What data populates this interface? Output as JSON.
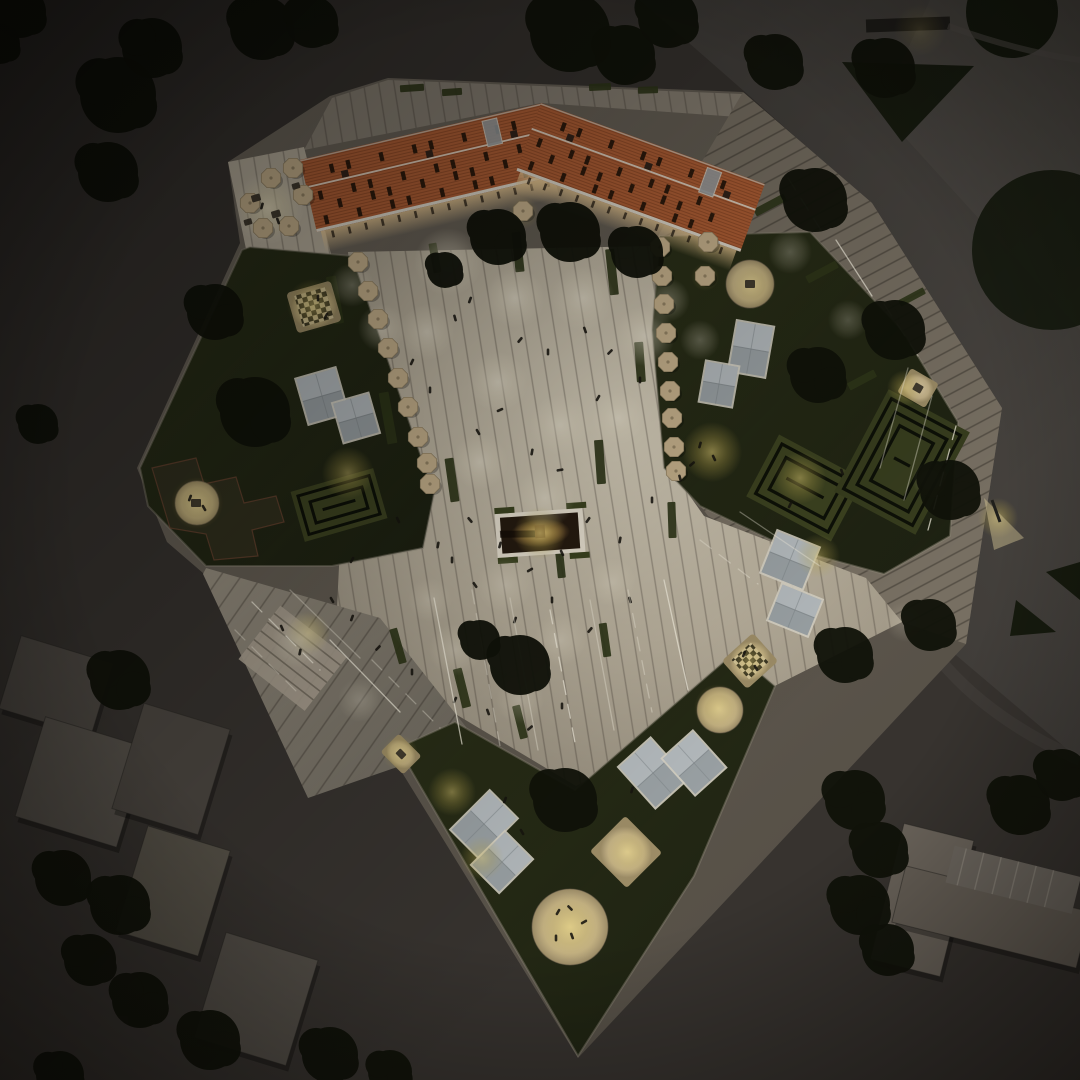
{
  "meta": {
    "description": "Aerial night rendering of an urban plaza with orange-roofed building, illuminated paving, gardens, mazes and surrounding blocks"
  },
  "colors": {
    "bg": "#37332f",
    "roof": "#b05f35",
    "eaves": "#ded8ca",
    "siteBase": "#6b6459",
    "umbrella": "#c6b18c",
    "umbrellaDark": "#8f7f60",
    "tree": "#101209",
    "person": "#17140f",
    "led": "#f7f2e2",
    "greenStrip": "#2f3619",
    "glassFrame": "#d5d0c3",
    "glassPane": "#99a0a3",
    "glassPaneLight": "#bcc2c4",
    "sandRim": "#6f6350",
    "hedge": "#0d1007",
    "mazeLawn": "#3c4220"
  },
  "building": {
    "wings": [
      {
        "x": 300,
        "y": 160,
        "w": 248,
        "h": 74,
        "rot": -13.2,
        "cx": 300,
        "cy": 160
      },
      {
        "x": 541,
        "y": 103,
        "w": 238,
        "h": 72,
        "rot": 19.9,
        "cx": 541,
        "cy": 103
      }
    ]
  },
  "scene": {
    "pools": [
      [
        448,
        262,
        34,
        0.5
      ],
      [
        515,
        298,
        30,
        0.55
      ],
      [
        583,
        298,
        32,
        0.5
      ],
      [
        645,
        336,
        30,
        0.5
      ],
      [
        427,
        332,
        28,
        0.45
      ],
      [
        498,
        382,
        30,
        0.5
      ],
      [
        560,
        425,
        30,
        0.45
      ],
      [
        480,
        462,
        28,
        0.45
      ],
      [
        618,
        418,
        26,
        0.4
      ],
      [
        545,
        498,
        30,
        0.4
      ],
      [
        382,
        328,
        24,
        0.4
      ],
      [
        352,
        285,
        22,
        0.35
      ],
      [
        668,
        300,
        22,
        0.35
      ],
      [
        700,
        340,
        20,
        0.3
      ],
      [
        505,
        585,
        28,
        0.3
      ],
      [
        455,
        650,
        26,
        0.3
      ],
      [
        560,
        640,
        26,
        0.28
      ],
      [
        612,
        582,
        24,
        0.28
      ],
      [
        520,
        700,
        24,
        0.25
      ],
      [
        430,
        600,
        22,
        0.25
      ],
      [
        790,
        252,
        22,
        0.3
      ],
      [
        848,
        320,
        20,
        0.25
      ],
      [
        300,
        640,
        28,
        0.4
      ],
      [
        360,
        700,
        22,
        0.25
      ],
      [
        930,
        480,
        18,
        0.2
      ],
      [
        268,
        208,
        36,
        0.5
      ],
      [
        905,
        622,
        20,
        0.18
      ]
    ],
    "glows": [
      [
        313,
        305,
        26,
        0.55
      ],
      [
        348,
        473,
        26,
        0.5
      ],
      [
        197,
        503,
        26,
        0.5
      ],
      [
        712,
        452,
        30,
        0.6
      ],
      [
        800,
        478,
        26,
        0.5
      ],
      [
        752,
        285,
        24,
        0.45
      ],
      [
        905,
        388,
        18,
        0.5
      ],
      [
        818,
        556,
        22,
        0.45
      ],
      [
        452,
        792,
        24,
        0.5
      ],
      [
        482,
        858,
        22,
        0.45
      ],
      [
        570,
        927,
        34,
        0.6
      ],
      [
        628,
        852,
        24,
        0.5
      ],
      [
        718,
        708,
        24,
        0.5
      ],
      [
        750,
        661,
        20,
        0.45
      ],
      [
        400,
        753,
        18,
        0.45
      ],
      [
        540,
        533,
        26,
        0.7
      ],
      [
        308,
        633,
        22,
        0.5
      ],
      [
        998,
        518,
        20,
        0.5
      ],
      [
        268,
        208,
        30,
        0.3
      ],
      [
        523,
        213,
        16,
        0.3
      ],
      [
        708,
        244,
        14,
        0.3
      ],
      [
        705,
        277,
        14,
        0.3
      ],
      [
        920,
        30,
        26,
        0.2
      ]
    ],
    "umbrellas": [
      [
        250,
        203
      ],
      [
        271,
        178
      ],
      [
        293,
        168
      ],
      [
        303,
        195
      ],
      [
        263,
        228
      ],
      [
        289,
        226
      ],
      [
        358,
        262
      ],
      [
        368,
        291
      ],
      [
        378,
        319
      ],
      [
        388,
        348
      ],
      [
        398,
        378
      ],
      [
        408,
        407
      ],
      [
        418,
        437
      ],
      [
        427,
        463
      ],
      [
        430,
        484
      ],
      [
        660,
        247
      ],
      [
        662,
        276
      ],
      [
        664,
        304
      ],
      [
        666,
        333
      ],
      [
        668,
        362
      ],
      [
        670,
        391
      ],
      [
        672,
        418
      ],
      [
        674,
        447
      ],
      [
        676,
        471
      ],
      [
        523,
        211
      ],
      [
        708,
        242
      ],
      [
        705,
        276
      ]
    ],
    "strips": [
      [
        335,
        300,
        10,
        48,
        -10
      ],
      [
        388,
        418,
        10,
        52,
        -10
      ],
      [
        452,
        480,
        9,
        44,
        -8
      ],
      [
        518,
        252,
        9,
        40,
        -6
      ],
      [
        612,
        272,
        9,
        46,
        -6
      ],
      [
        640,
        362,
        9,
        40,
        -4
      ],
      [
        600,
        462,
        9,
        44,
        -4
      ],
      [
        672,
        520,
        8,
        36,
        -2
      ],
      [
        462,
        688,
        9,
        40,
        -14
      ],
      [
        520,
        722,
        8,
        34,
        -14
      ],
      [
        398,
        646,
        8,
        36,
        -16
      ],
      [
        435,
        258,
        8,
        30,
        -10
      ],
      [
        560,
        560,
        8,
        36,
        -6
      ],
      [
        605,
        640,
        8,
        34,
        -8
      ],
      [
        412,
        88,
        24,
        7,
        -4
      ],
      [
        452,
        92,
        20,
        7,
        -4
      ],
      [
        600,
        87,
        22,
        7,
        -3
      ],
      [
        648,
        90,
        20,
        7,
        -2
      ],
      [
        770,
        205,
        8,
        34,
        62
      ],
      [
        822,
        272,
        8,
        34,
        62
      ],
      [
        862,
        380,
        8,
        30,
        62
      ],
      [
        912,
        297,
        7,
        28,
        62
      ],
      [
        890,
        430,
        7,
        26,
        62
      ]
    ],
    "skylights": [
      [
        322,
        396,
        40,
        46,
        -16
      ],
      [
        356,
        418,
        36,
        40,
        -16
      ],
      [
        751,
        349,
        36,
        50,
        10
      ],
      [
        719,
        384,
        32,
        40,
        10
      ],
      [
        790,
        560,
        44,
        44,
        22
      ],
      [
        795,
        610,
        42,
        38,
        22
      ],
      [
        484,
        824,
        38,
        54,
        45
      ],
      [
        502,
        862,
        38,
        46,
        45
      ],
      [
        653,
        773,
        42,
        54,
        -42
      ],
      [
        694,
        763,
        40,
        48,
        -42
      ]
    ],
    "patios": [
      [
        197,
        503,
        22
      ],
      [
        750,
        284,
        24
      ],
      [
        570,
        927,
        38
      ],
      [
        720,
        710,
        23
      ]
    ],
    "squares": [
      [
        918,
        388,
        32,
        28,
        30
      ],
      [
        626,
        852,
        52,
        50,
        45
      ],
      [
        401,
        754,
        32,
        26,
        45
      ]
    ],
    "chess": [
      [
        314,
        307,
        46,
        42,
        -16,
        32
      ],
      [
        750,
        661,
        42,
        38,
        -42,
        26
      ]
    ],
    "leds": [
      [
        434,
        598,
        462,
        744
      ],
      [
        472,
        590,
        500,
        746
      ],
      [
        510,
        598,
        538,
        750
      ],
      [
        550,
        610,
        576,
        748
      ],
      [
        590,
        600,
        614,
        730
      ],
      [
        628,
        590,
        652,
        712
      ],
      [
        664,
        580,
        688,
        690
      ],
      [
        700,
        540,
        758,
        584
      ],
      [
        740,
        512,
        820,
        566
      ],
      [
        252,
        602,
        320,
        670
      ],
      [
        290,
        590,
        360,
        658
      ],
      [
        235,
        630,
        300,
        695
      ],
      [
        330,
        640,
        400,
        712
      ],
      [
        372,
        660,
        440,
        728
      ],
      [
        932,
        396,
        904,
        500
      ],
      [
        956,
        426,
        928,
        530
      ],
      [
        908,
        368,
        880,
        468
      ],
      [
        788,
        178,
        826,
        238
      ],
      [
        836,
        240,
        872,
        296
      ],
      [
        884,
        304,
        918,
        356
      ]
    ],
    "blocks": [
      [
        8,
        648,
        96,
        76,
        17,
        "#4f4a44"
      ],
      [
        28,
        730,
        106,
        104,
        17,
        "#57524b"
      ],
      [
        126,
        714,
        90,
        110,
        17,
        "#4c4741"
      ],
      [
        130,
        836,
        86,
        110,
        17,
        "#585349"
      ],
      [
        208,
        944,
        96,
        110,
        17,
        "#544f48"
      ],
      [
        886,
        830,
        72,
        140,
        14,
        "#6b645b"
      ],
      [
        896,
        888,
        190,
        58,
        14,
        "#665f56"
      ]
    ],
    "trees": [
      [
        118,
        95,
        38
      ],
      [
        152,
        48,
        30
      ],
      [
        108,
        172,
        30
      ],
      [
        262,
        28,
        32
      ],
      [
        312,
        22,
        26
      ],
      [
        570,
        32,
        40
      ],
      [
        625,
        55,
        30
      ],
      [
        668,
        18,
        30
      ],
      [
        775,
        62,
        28
      ],
      [
        20,
        12,
        26
      ],
      [
        0,
        44,
        20
      ],
      [
        38,
        424,
        20
      ],
      [
        498,
        237,
        28
      ],
      [
        570,
        232,
        30
      ],
      [
        637,
        252,
        26
      ],
      [
        445,
        270,
        18
      ],
      [
        255,
        412,
        35
      ],
      [
        215,
        312,
        28
      ],
      [
        520,
        665,
        30
      ],
      [
        565,
        800,
        32
      ],
      [
        480,
        640,
        20
      ],
      [
        815,
        200,
        32
      ],
      [
        895,
        330,
        30
      ],
      [
        818,
        375,
        28
      ],
      [
        950,
        490,
        30
      ],
      [
        930,
        625,
        26
      ],
      [
        845,
        655,
        28
      ],
      [
        1020,
        805,
        30
      ],
      [
        1062,
        775,
        26
      ],
      [
        885,
        68,
        30
      ],
      [
        855,
        800,
        30
      ],
      [
        880,
        850,
        28
      ],
      [
        860,
        905,
        30
      ],
      [
        888,
        950,
        26
      ],
      [
        63,
        878,
        28
      ],
      [
        120,
        905,
        30
      ],
      [
        90,
        960,
        26
      ],
      [
        140,
        1000,
        28
      ],
      [
        210,
        1040,
        30
      ],
      [
        330,
        1055,
        28
      ],
      [
        60,
        1075,
        24
      ],
      [
        120,
        680,
        30
      ],
      [
        390,
        1072,
        22
      ]
    ],
    "people": [
      [
        470,
        300,
        20
      ],
      [
        455,
        318,
        -15
      ],
      [
        520,
        340,
        40
      ],
      [
        548,
        352,
        0
      ],
      [
        500,
        410,
        65
      ],
      [
        478,
        432,
        -30
      ],
      [
        532,
        452,
        10
      ],
      [
        560,
        470,
        80
      ],
      [
        430,
        390,
        0
      ],
      [
        412,
        362,
        25
      ],
      [
        585,
        330,
        -20
      ],
      [
        610,
        352,
        45
      ],
      [
        640,
        380,
        0
      ],
      [
        598,
        398,
        30
      ],
      [
        470,
        520,
        -40
      ],
      [
        500,
        545,
        15
      ],
      [
        452,
        560,
        0
      ],
      [
        530,
        570,
        60
      ],
      [
        562,
        553,
        -25
      ],
      [
        620,
        540,
        10
      ],
      [
        588,
        520,
        35
      ],
      [
        652,
        500,
        0
      ],
      [
        680,
        478,
        -15
      ],
      [
        352,
        618,
        20
      ],
      [
        332,
        600,
        -30
      ],
      [
        378,
        648,
        45
      ],
      [
        412,
        672,
        0
      ],
      [
        455,
        700,
        25
      ],
      [
        488,
        712,
        -20
      ],
      [
        530,
        728,
        50
      ],
      [
        562,
        706,
        0
      ],
      [
        352,
        560,
        30
      ],
      [
        398,
        520,
        -25
      ],
      [
        438,
        545,
        10
      ],
      [
        475,
        585,
        -35
      ],
      [
        515,
        620,
        20
      ],
      [
        552,
        600,
        0
      ],
      [
        590,
        630,
        40
      ],
      [
        630,
        600,
        -18
      ],
      [
        300,
        652,
        12
      ],
      [
        282,
        628,
        -24
      ],
      [
        558,
        912,
        30
      ],
      [
        572,
        936,
        -20
      ],
      [
        584,
        922,
        60
      ],
      [
        556,
        938,
        0
      ],
      [
        570,
        908,
        -45
      ],
      [
        190,
        498,
        20
      ],
      [
        204,
        508,
        -30
      ],
      [
        700,
        445,
        15
      ],
      [
        714,
        458,
        -25
      ],
      [
        692,
        464,
        50
      ],
      [
        318,
        298,
        0
      ],
      [
        326,
        316,
        30
      ],
      [
        744,
        654,
        20
      ],
      [
        756,
        668,
        -30
      ],
      [
        262,
        206,
        15
      ],
      [
        278,
        221,
        -20
      ],
      [
        790,
        505,
        25
      ],
      [
        842,
        472,
        -20
      ],
      [
        505,
        800,
        20
      ],
      [
        522,
        832,
        -30
      ],
      [
        632,
        790,
        15
      ]
    ],
    "props": [
      [
        256,
        198,
        9,
        7,
        -16
      ],
      [
        276,
        214,
        9,
        7,
        -16
      ],
      [
        296,
        186,
        8,
        6,
        -16
      ],
      [
        248,
        222,
        8,
        6,
        -16
      ],
      [
        196,
        503,
        10,
        8,
        0
      ],
      [
        750,
        284,
        10,
        8,
        0
      ],
      [
        918,
        388,
        9,
        8,
        30
      ],
      [
        401,
        754,
        9,
        7,
        45
      ]
    ]
  }
}
